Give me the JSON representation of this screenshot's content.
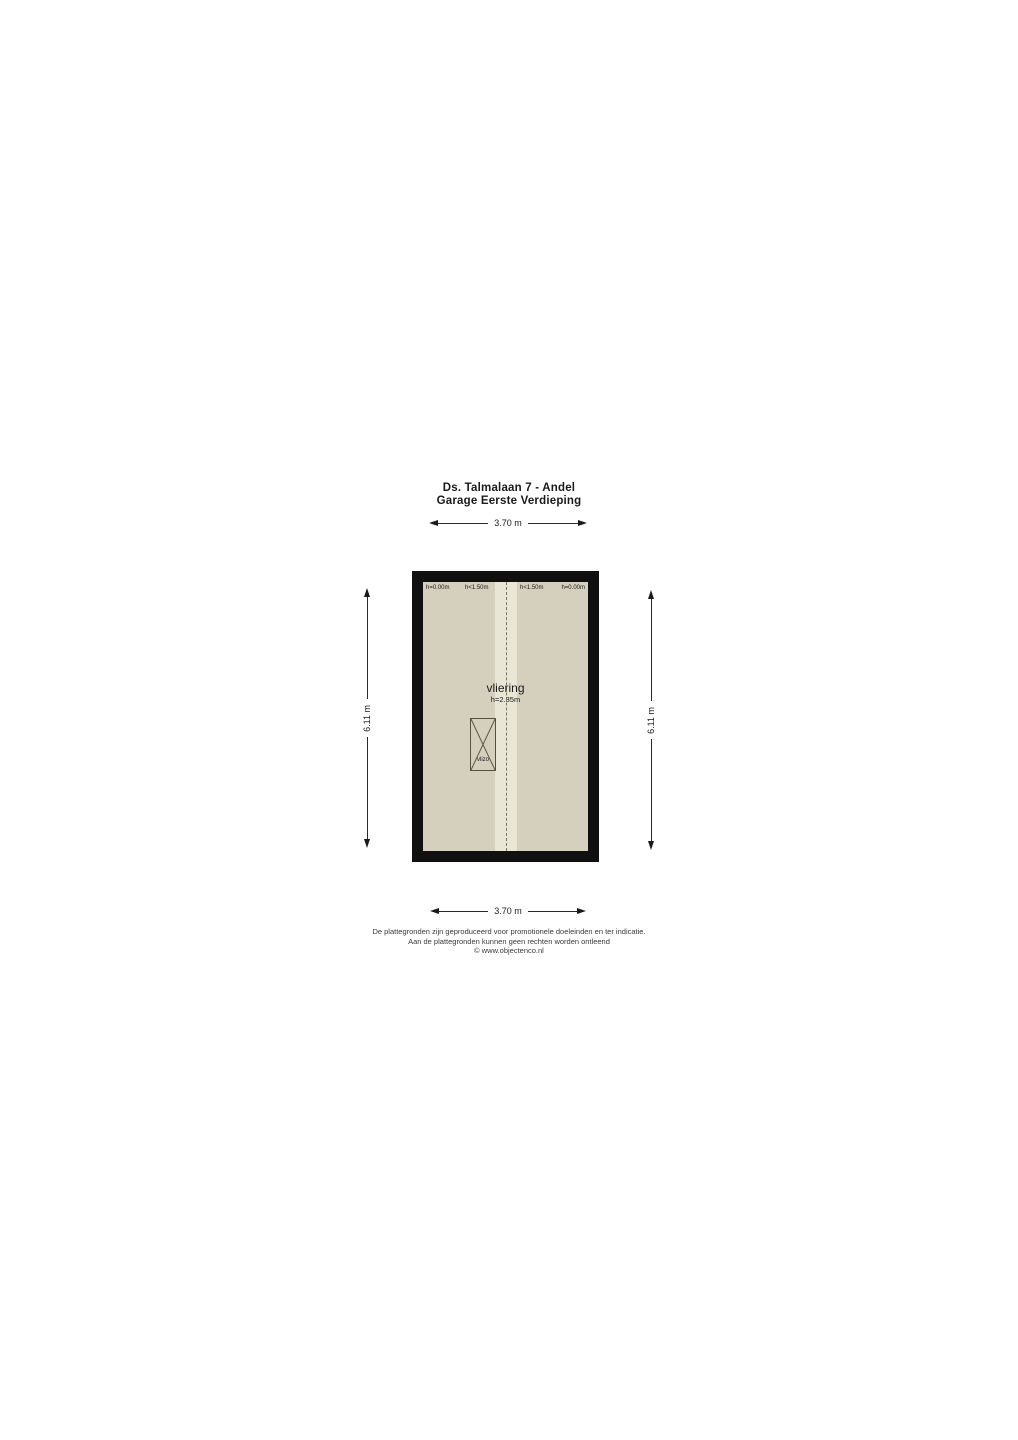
{
  "title": {
    "line1": "Ds. Talmalaan 7 - Andel",
    "line2": "Garage Eerste Verdieping"
  },
  "dimensions": {
    "top": "3.70 m",
    "bottom": "3.70 m",
    "left": "6.11 m",
    "right": "6.11 m"
  },
  "plan": {
    "height_labels": [
      "h=0.00m",
      "h<1.50m",
      "h<1.50m",
      "h=0.00m"
    ],
    "room": {
      "name": "vliering",
      "height": "h=2.35m"
    },
    "hatch_label": "vlizo"
  },
  "colors": {
    "wall": "#101010",
    "floor": "#d5cfbd",
    "ridge_strip": "#eae6d6"
  },
  "footer": {
    "line1": "De plattegronden zijn geproduceerd voor promotionele doeleinden en ter indicatie.",
    "line2": "Aan de plattegronden kunnen geen rechten worden ontleend",
    "line3": "© www.objectenco.nl"
  }
}
